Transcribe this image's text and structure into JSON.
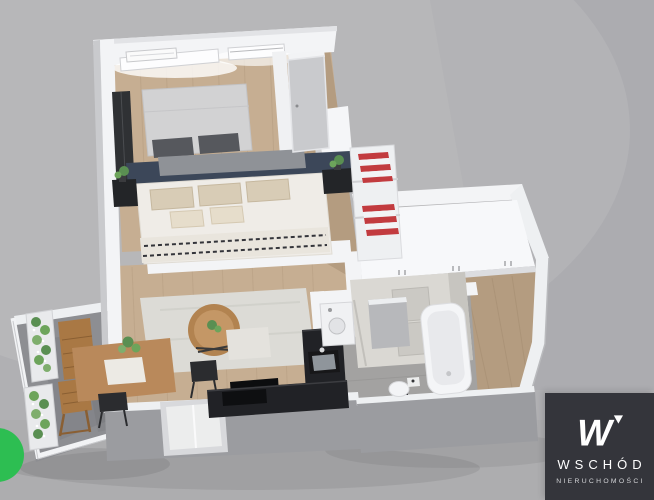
{
  "watermark": {
    "monogram": "W",
    "company_name": "WSCHÓD",
    "company_subtitle": "NIERUCHOMOŚCI"
  },
  "colors": {
    "background": "#b0b0b3",
    "logo_background": "#34353b",
    "logo_text": "#ffffff",
    "badge_green": "#2dbe52",
    "wall_white": "#f3f4f6",
    "wall_shadow": "#9b9ca0",
    "wood_floor": "#c6ae92",
    "hall_floor": "#b49c80",
    "tile_floor": "#a3a2a1",
    "balcony_floor": "#8d8e92",
    "accent_navy": "#3c4759",
    "counter_black": "#212226",
    "sofa_gray": "#dad8d3",
    "rug": "#dcdbd6",
    "table_wood": "#b9895b",
    "balcony_wood": "#a97844",
    "plant_green": "#5a8f52",
    "towel_red": "#c23b3f"
  },
  "scene": {
    "type": "3d-apartment-floorplan-render",
    "rooms": [
      {
        "name": "bedroom",
        "furniture": [
          "single-bed",
          "double-bed",
          "headboard-wall",
          "nightstands",
          "plants",
          "dark-wardrobe",
          "towel-shelf",
          "windows",
          "ac-unit"
        ]
      },
      {
        "name": "living-room",
        "furniture": [
          "sofa",
          "ottoman",
          "rug",
          "round-coffee-table",
          "dining-table",
          "black-chairs",
          "tv"
        ]
      },
      {
        "name": "kitchen",
        "furniture": [
          "l-shaped-black-counter",
          "sink",
          "cooktop"
        ]
      },
      {
        "name": "bathroom",
        "furniture": [
          "bathtub",
          "toilet",
          "washing-machine",
          "shower-partition"
        ]
      },
      {
        "name": "hallway",
        "furniture": [
          "built-in-wardrobes"
        ]
      },
      {
        "name": "balcony",
        "furniture": [
          "folding-table",
          "folding-chair",
          "planters-with-flowers",
          "railing",
          "radiator"
        ]
      }
    ]
  }
}
